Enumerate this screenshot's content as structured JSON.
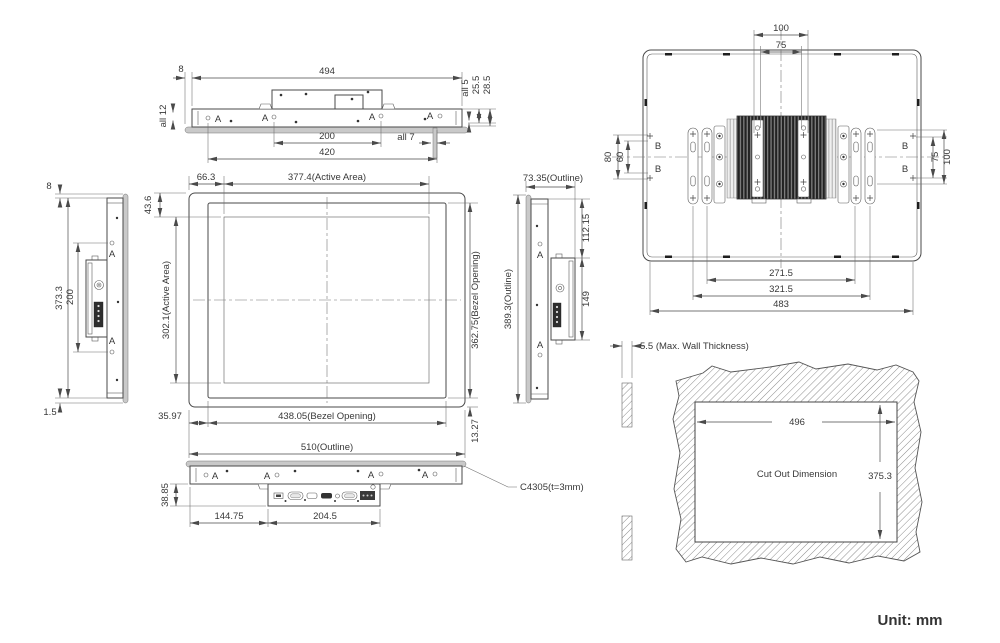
{
  "unit_label": "Unit: mm",
  "markers": {
    "a": "A",
    "b": "B"
  },
  "top_view": {
    "d8": "8",
    "d494": "494",
    "all12": "all 12",
    "all5": "all 5",
    "d25_5": "25.5",
    "d28_5": "28.5",
    "d200": "200",
    "all7": "all 7",
    "d420": "420"
  },
  "left_view": {
    "d8": "8",
    "d373_3": "373.3",
    "d200": "200",
    "d1_5": "1.5"
  },
  "front_view": {
    "d66_3": "66.3",
    "active_w": "377.4(Active Area)",
    "d43_6": "43.6",
    "active_h": "302.1(Active Area)",
    "bezel_h": "362.75(Bezel Opening)",
    "d35_97": "35.97",
    "bezel_w": "438.05(Bezel Opening)",
    "d13_27": "13.27",
    "outline_w": "510(Outline)"
  },
  "right_view": {
    "outline_d": "73.35(Outline)",
    "d112_15": "112.15",
    "d149": "149",
    "outline_h": "389.3(Outline)"
  },
  "rear_view": {
    "d100_top": "100",
    "d75_top": "75",
    "d80": "80",
    "d60": "60",
    "d75_right": "75",
    "d100_right": "100",
    "d271_5": "271.5",
    "d321_5": "321.5",
    "d483": "483"
  },
  "bottom_view": {
    "d38_85": "38.85",
    "d144_75": "144.75",
    "d204_5": "204.5",
    "note": "C4305(t=3mm)"
  },
  "cutout_view": {
    "wall": "5.5 (Max. Wall Thickness)",
    "d496": "496",
    "label": "Cut Out Dimension",
    "d375_3": "375.3"
  }
}
